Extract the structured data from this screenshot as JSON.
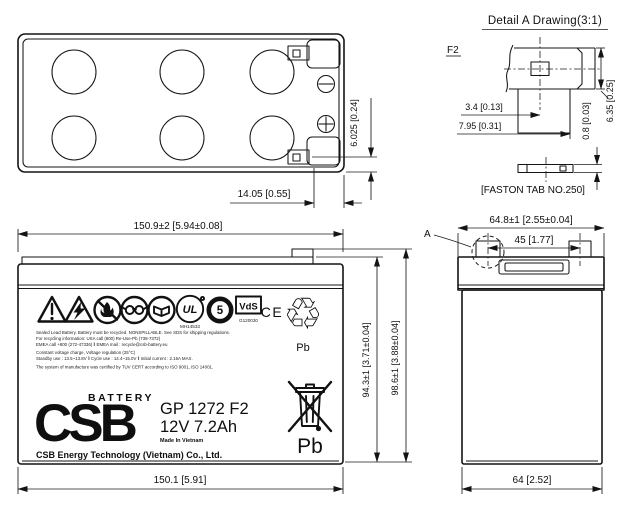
{
  "drawing": {
    "detail_title": "Detail A Drawing(3:1)",
    "terminal_type_label": "F2",
    "faston_caption": "[FASTON TAB NO.250]",
    "detail_marker": "A"
  },
  "dims": {
    "top_tab_inset": "14.05 [0.55]",
    "top_terminal_edge": "6.025 [0.24]",
    "detail_hole_offset": "3.4 [0.13]",
    "detail_base_width": "7.95 [0.31]",
    "detail_tab_thickness": "0.8 [0.03]",
    "detail_tab_width": "6.35 [0.25]",
    "front_overall_width": "150.9±2 [5.94±0.08]",
    "front_base_width": "150.1 [5.91]",
    "front_case_height": "94.3±1 [3.71±0.04]",
    "front_total_height": "98.6±1 [3.88±0.04]",
    "side_overall_width": "64.8±1 [2.55±0.04]",
    "side_terminal_spacing": "45 [1.77]",
    "side_base_width": "64 [2.52]"
  },
  "label": {
    "ul_mark": "UL",
    "ul_number": "MH14533",
    "recycle_number": "5",
    "vds_mark": "VdS",
    "vds_number": "G120030",
    "ce_mark": "CE",
    "recycle_symbol": "♲",
    "pb_recycle": "Pb",
    "pb_bin": "Pb",
    "lines": [
      "Sealed Lead Battery. Battery must be recycled. NONSPILLABLE. See SDS for shipping regulations.",
      "For recycling information: USA call (800) Re-Use-Pb (738-7372)",
      "EMEA call +800 (272-47336)  ‖  EMEA mail : recycle@csb-battery.eu",
      "Constant voltage charge, Voltage regulation (25°C)",
      "Standby use : 13.5~13.8V  ‖  Cycle use : 14.4~15.0V  ‖  Initial current : 2.16A MAX.",
      "The system of manufacture was certified by TUV CERT according to ISO 9001, ISO 14001."
    ],
    "brand_battery": "BATTERY",
    "brand_logo": "CSB",
    "model": "GP 1272 F2",
    "rating": "12V 7.2Ah",
    "origin": "Made In Vietnam",
    "company": "CSB Energy Technology (Vietnam) Co., Ltd."
  }
}
